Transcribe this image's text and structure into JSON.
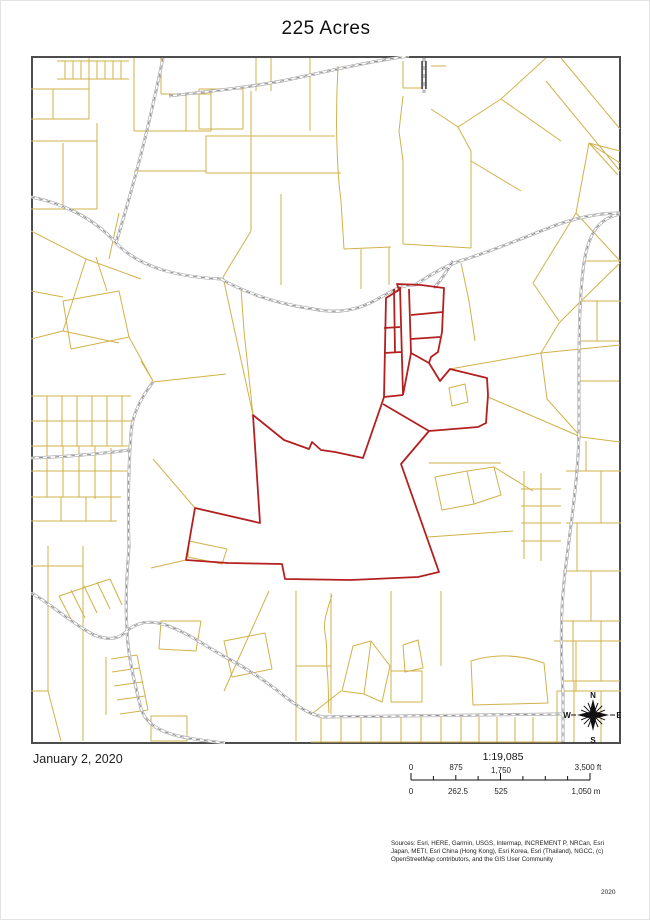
{
  "page": {
    "title": "225 Acres"
  },
  "map": {
    "date": "January 2, 2020",
    "compass": {
      "north": "N",
      "east": "E",
      "south": "S",
      "west": "W"
    },
    "colors": {
      "parcel_line": "#d2b14a",
      "road_casing": "#a3a3a3",
      "road_dash": "#555555",
      "boundary_red": "#b42020",
      "frame": "#4d4d4d"
    },
    "red_paths": [
      "M385,297 L398,289 L396,283 L420,284 L443,287 L441,331 L437,351 L430,356 L428,362 L439,380 L449,368 L486,377 L487,394 L485,422 L477,426 L428,430 L400,463 L438,571 L417,576 L350,579 L284,578 L281,563 L227,562 L185,559 L194,507 L259,522 L252,414 L283,439 L308,448 L311,441 L320,449 L334,451 L362,457 L381,402 L383,396 Z",
      "M382,403 L428,430 M399,286 L402,394 M393,288 L394,351 M383,327 L399,326 M383,352 L400,351 M383,396 L402,394 M408,288 L410,352 M410,314 L442,311 M410,338 L439,336 M410,352 L428,362 M410,352 L402,394"
    ],
    "yellow_paths": [
      "M56,60 H128 M56,78 H128 M64,60 V78 M72,60 V78 M80,60 V78 M88,60 V78 M96,60 V78 M104,60 V78 M112,60 V78 M120,60 V78",
      "M30,88 H88 M88,57 V118 M30,118 H88 M52,88 V118 M30,140 H96 M96,122 V208 M30,208 H96 M62,142 V206",
      "M30,230 L85,258 L62,330 L30,338 M85,258 L140,278 M118,212 L108,258 M62,330 L118,342 M30,290 L62,296",
      "M62,300 L118,290 L128,336 L70,348 Z M95,256 L106,290 M128,336 L152,380",
      "M133,57 V130 M133,130 H210 M210,91 V130 M160,93 H210 M160,57 V93 M185,93 V130 M133,170 H205",
      "M198,88 H242 V128 H198 Z M205,135 H250 V172 H205 Z M250,90 V230 M250,135 H334 M250,172 H340 M250,230 L222,276",
      "M280,193 V284 M337,65 C334,120 336,170 340,200 L343,248 M343,248 L390,246 M360,248 V288 M388,246 V284 M309,57 V130 M270,57 V90 M255,57 V90",
      "M402,60 V87 M402,87 H420 M430,65 H445 M402,95 L398,130 L402,160 V243 M402,243 L470,247 M470,150 V247 M430,108 L457,126 L470,150 M457,126 L500,98 L545,57 M500,98 L560,140 M470,160 L520,190",
      "M619,128 L560,57 M619,170 L545,80 M588,142 L619,150 M588,142 L619,162 M588,142 L617,174 M588,142 L575,212 M575,212 L619,260 M575,212 L532,282 M532,282 L558,320",
      "M449,368 L540,352 L619,344 M487,396 L580,436 L619,441 M540,352 L546,398 L580,436 M619,262 L578,302 L558,322 L540,352 M460,262 L468,300 L474,340",
      "M448,387 L464,383 L467,401 L451,405 Z M428,462 H500 M434,476 L466,470 L473,503 L441,509 Z M466,470 L493,466 L500,494 L473,503 Z M493,466 L532,490 M427,536 L512,530",
      "M565,470 H620 M585,440 V470 M600,470 V522 M565,522 H620 M576,522 V570 M562,570 H620 M590,570 V620 M562,620 H619 M572,620 V680 M560,680 H619 M573,680 V741 M600,620 V680 M523,470 V558 M540,472 V560 M520,488 H560 M520,505 H560 M520,522 H560 M520,540 H560",
      "M30,395 H130 M30,420 H133 M30,445 H130 M46,395 V445 M61,395 V445 M76,395 V445 M91,395 V445 M106,395 V445 M121,395 V445",
      "M30,470 H126 M30,496 H120 M46,445 V496 M62,445 V496 M78,445 V496 M94,445 V498 M110,447 V520 M30,520 H116 M60,496 V520 M85,496 V520",
      "M140,360 L152,380 M152,381 L225,373 M222,276 L252,414 M252,414 L243,330 L240,287 M194,507 L152,458 M150,567 L185,559",
      "M47,545 V690 M82,545 V740 M30,565 H82 M30,690 H47 M47,690 L60,740",
      "M58,595 L72,622 M70,589 L84,617 M83,585 L96,612 M96,581 L109,608 M109,578 L121,604 M58,595 L109,578",
      "M105,656 V714 M110,658 L136,654 M111,671 L138,667 M113,685 L141,681 M116,699 L144,695 M119,713 L147,709 M136,654 L147,709",
      "M150,715 H186 V740 H150 Z M188,540 L226,548 L221,563 L187,556 Z M160,620 H200 L195,650 L158,648 Z",
      "M268,590 L223,690 M223,640 L264,632 L271,668 L231,676 Z M295,590 V740 M295,665 H330 M330,592 V713 M390,590 V670 M440,590 V665",
      "M331,594 C326,610 322,620 324,632 C327,646 325,658 326,668 C328,684 327,698 328,712",
      "M352,645 L370,640 L363,693 L341,690 Z M370,640 L389,665 L381,701 L363,693 Z M390,670 H421 V701 H390 Z M402,644 L417,639 L422,667 L404,671 Z M340,690 L312,712",
      "M320,716 V741 M340,715 V741 M360,715 V741 M380,715 V741 M400,715 V741 M420,715 V741 M440,714 V741 M310,741 H448 M460,716 V741 M478,716 V741 M496,716 V741 M514,716 V741 M532,716 V741 M448,714 H560 M448,741 H560",
      "M470,660 C495,652 520,654 543,662 L547,702 L472,704 Z M553,640 H620 M575,640 V690 M556,690 H620 M600,690 V741 M556,690 V741",
      "M578,300 H620 M578,340 H618 M582,260 H620 M596,300 V340 M578,380 H618"
    ],
    "road_paths": [
      "M162,57 C152,105 140,160 115,242",
      "M30,196 C60,202 92,216 115,242 C140,268 180,276 220,278 C252,296 285,304 312,308 C342,314 362,307 382,295 C396,287 402,284 414,284 C432,272 448,263 462,259 C482,253 520,238 545,228 C572,217 596,212 619,212",
      "M168,95 C210,90 255,86 300,76 C340,67 385,58 408,55",
      "M452,260 C446,270 440,279 433,287",
      "M619,213 C600,217 588,229 583,262 C577,302 578,362 578,424 C578,472 570,522 564,572 C559,612 560,652 562,692 C562,716 562,730 562,741",
      "M30,592 C46,600 70,622 93,634 C112,641 120,636 127,629 C141,618 156,620 170,626 C188,633 206,646 226,657 C243,666 262,678 282,694 C302,710 312,714 322,716 L560,713",
      "M152,381 C139,398 131,415 130,432 C127,472 127,512 128,546 C126,572 124,602 126,628 C127,658 134,682 139,704 C143,724 162,732 182,736 C202,740 216,741 224,742",
      "M30,457 C60,456 100,453 128,449",
      "M423,57 V92"
    ],
    "rail_paths": [
      "M421,60 V88 M425,60 V88"
    ]
  },
  "scalebar": {
    "ratio": "1:19,085",
    "ft": [
      "0",
      "875",
      "1,750",
      "3,500 ft"
    ],
    "m": [
      "0",
      "262.5",
      "525",
      "1,050 m"
    ]
  },
  "credits": {
    "sources": "Sources: Esri, HERE, Garmin, USGS, Intermap, INCREMENT P, NRCan, Esri Japan, METI, Esri China (Hong Kong), Esri Korea, Esri (Thailand), NGCC, (c) OpenStreetMap contributors, and the GIS User Community",
    "year": "2020"
  }
}
